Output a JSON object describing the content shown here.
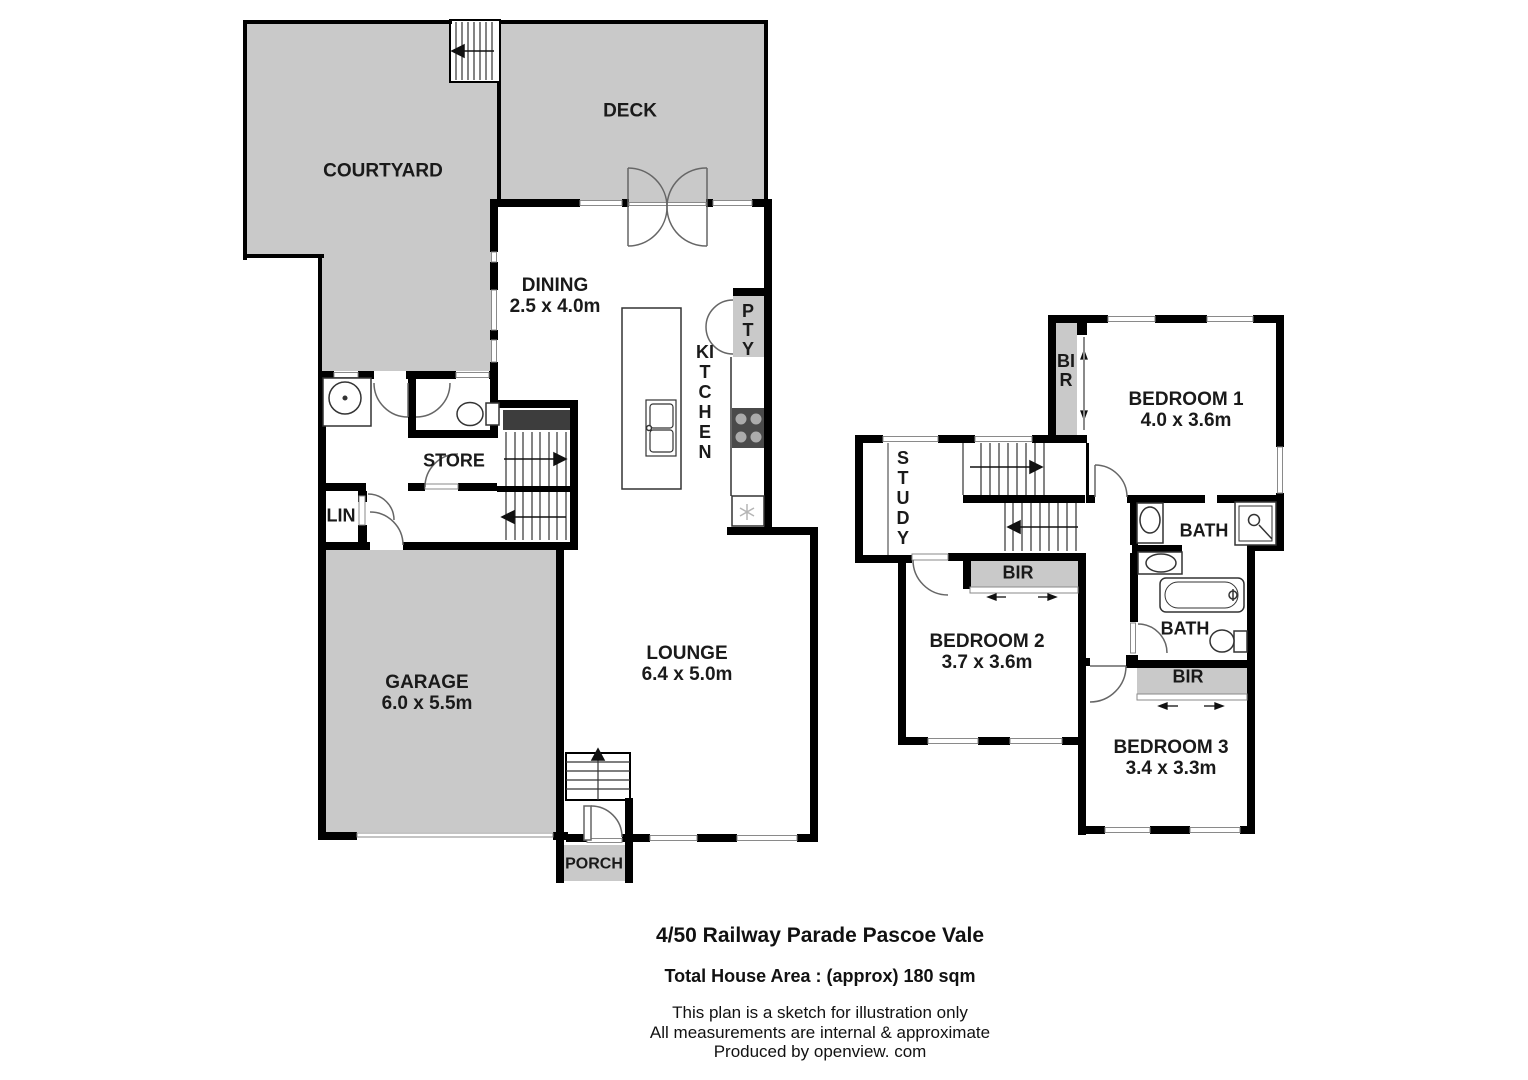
{
  "ground_floor": {
    "courtyard_label": "COURTYARD",
    "deck_label": "DECK",
    "dining": {
      "name": "DINING",
      "dims": "2.5 x 4.0m"
    },
    "kitchen_label": "KITCHEN",
    "pantry_label": "PTY",
    "store_label": "STORE",
    "linen_label": "LIN",
    "garage": {
      "name": "GARAGE",
      "dims": "6.0 x 5.5m"
    },
    "lounge": {
      "name": "LOUNGE",
      "dims": "6.4 x 5.0m"
    },
    "porch_label": "PORCH"
  },
  "upper_floor": {
    "bedroom1": {
      "name": "BEDROOM 1",
      "dims": "4.0 x 3.6m"
    },
    "bedroom2": {
      "name": "BEDROOM 2",
      "dims": "3.7 x 3.6m"
    },
    "bedroom3": {
      "name": "BEDROOM 3",
      "dims": "3.4 x 3.3m"
    },
    "study_label": "STUDY",
    "bir1_label": "BIR",
    "bir2_label": "BIR",
    "bir3_label": "BIR",
    "bath1_label": "BATH",
    "bath2_label": "BATH"
  },
  "footer": {
    "address": "4/50 Railway Parade Pascoe Vale",
    "area": "Total House Area : (approx) 180 sqm",
    "note1": "This plan is a sketch for illustration only",
    "note2": "All measurements are internal & approximate",
    "credit": "Produced by openview. com"
  },
  "colors": {
    "outdoor_fill": "#c9c9c9",
    "wall": "#000000",
    "bench": "#3d3d3d"
  }
}
